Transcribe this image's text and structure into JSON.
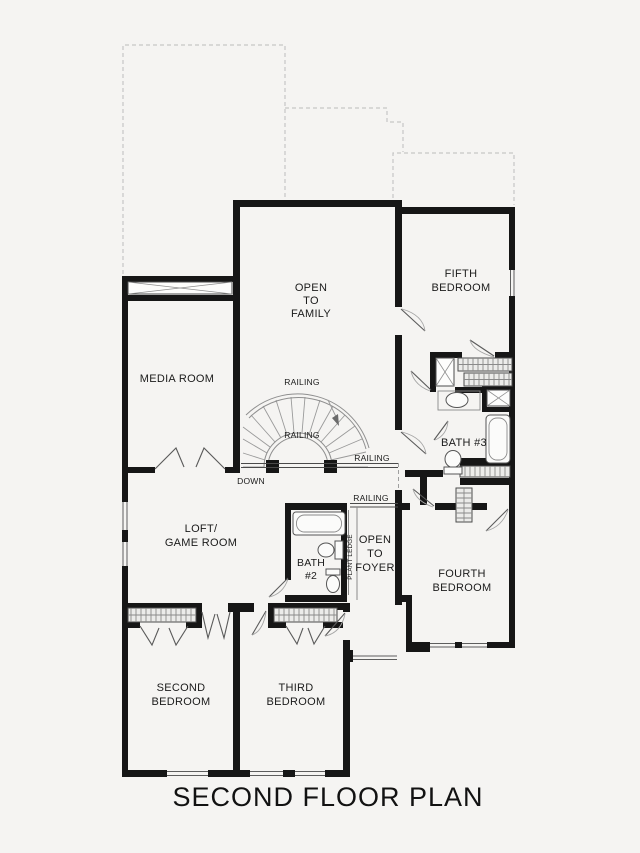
{
  "title": "SECOND FLOOR PLAN",
  "rooms": {
    "open_to_family": {
      "lines": [
        "OPEN",
        "TO",
        "FAMILY"
      ]
    },
    "fifth_bedroom": {
      "lines": [
        "FIFTH",
        "BEDROOM"
      ]
    },
    "media_room": {
      "lines": [
        "MEDIA ROOM"
      ]
    },
    "bath_3": {
      "lines": [
        "BATH #3"
      ]
    },
    "loft_game_room": {
      "lines": [
        "LOFT/",
        "GAME ROOM"
      ]
    },
    "bath_2": {
      "lines": [
        "BATH",
        "#2"
      ]
    },
    "open_to_foyer": {
      "lines": [
        "OPEN",
        "TO",
        "FOYER"
      ]
    },
    "fourth_bedroom": {
      "lines": [
        "FOURTH",
        "BEDROOM"
      ]
    },
    "second_bedroom": {
      "lines": [
        "SECOND",
        "BEDROOM"
      ]
    },
    "third_bedroom": {
      "lines": [
        "THIRD",
        "BEDROOM"
      ]
    }
  },
  "annotations": {
    "railing": "RAILING",
    "down": "DOWN",
    "plant_ledge": "PLANT LEDGE"
  },
  "colors": {
    "wall": "#161616",
    "thin_line": "#8a8a8a",
    "dash": "#c6c6c6",
    "background": "#f5f4f2",
    "text": "#1b1b1b"
  }
}
